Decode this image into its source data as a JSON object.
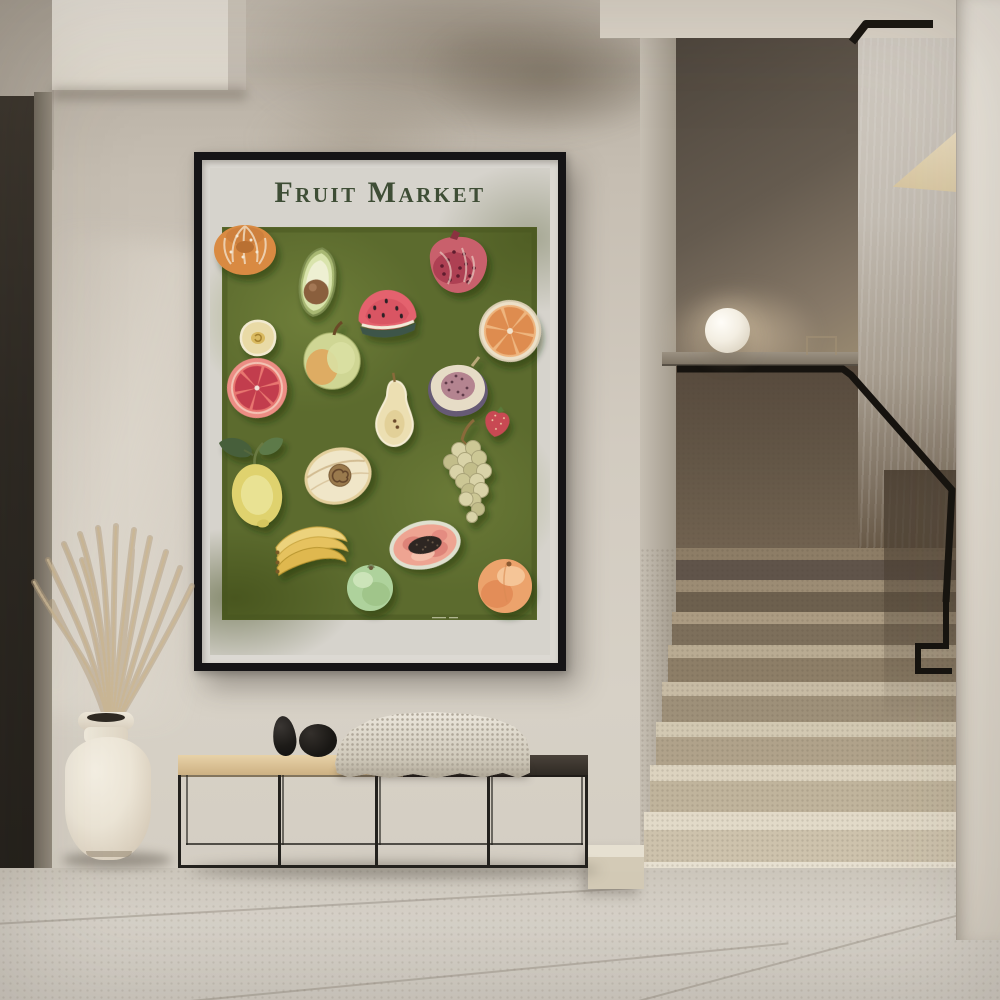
{
  "image": {
    "kind": "interior photograph",
    "caption": "Minimalist hallway with a framed Fruit Market art print above a black metal bench, a cream ceramic vase of dried pampas grass, and a beige stone staircase with black handrail and sphere lamp"
  },
  "poster": {
    "title": "Fruit Market",
    "palette": {
      "frame": "#151416",
      "mat": "#dcd9d3",
      "print_background": "#d6d3cc",
      "panel_green": "#5c6b2e",
      "title_text": "#3e4d35"
    },
    "fruits": [
      {
        "name": "tangerine",
        "color": "#d98a43"
      },
      {
        "name": "avocado-half",
        "color": "#d9e4ac"
      },
      {
        "name": "pomegranate",
        "color": "#c9606c"
      },
      {
        "name": "watermelon-slice",
        "color": "#e4626e"
      },
      {
        "name": "orange-slice",
        "color": "#de8c50"
      },
      {
        "name": "white-peach-half",
        "color": "#e9daa6"
      },
      {
        "name": "quince",
        "color": "#cfd694"
      },
      {
        "name": "grapefruit-half",
        "color": "#e8766f"
      },
      {
        "name": "fig-half",
        "color": "#665a74"
      },
      {
        "name": "pear-half",
        "color": "#ecdfb2"
      },
      {
        "name": "strawberry",
        "color": "#c84a52"
      },
      {
        "name": "lemon",
        "color": "#dfd26e"
      },
      {
        "name": "melon-half",
        "color": "#f0e6c8"
      },
      {
        "name": "green-grapes",
        "color": "#d9d3a8"
      },
      {
        "name": "bananas",
        "color": "#e9c768"
      },
      {
        "name": "papaya-half",
        "color": "#eea492"
      },
      {
        "name": "green-apple",
        "color": "#aed29c"
      },
      {
        "name": "peach",
        "color": "#eca36c"
      }
    ],
    "signature": "tiny illegible artist signature"
  },
  "furnishings": {
    "bench": "black metal frame bench, two-tone seat",
    "bench_decor": [
      "tall black pebble object",
      "round black pebble object",
      "folded knit throw"
    ],
    "vase": "cream ceramic vase",
    "plant": "dried pampas grass"
  },
  "staircase": {
    "steps_visible": 9,
    "material": "beige terrazzo stone",
    "handrail_color": "#16130f",
    "lamp": "white sphere lamp"
  }
}
